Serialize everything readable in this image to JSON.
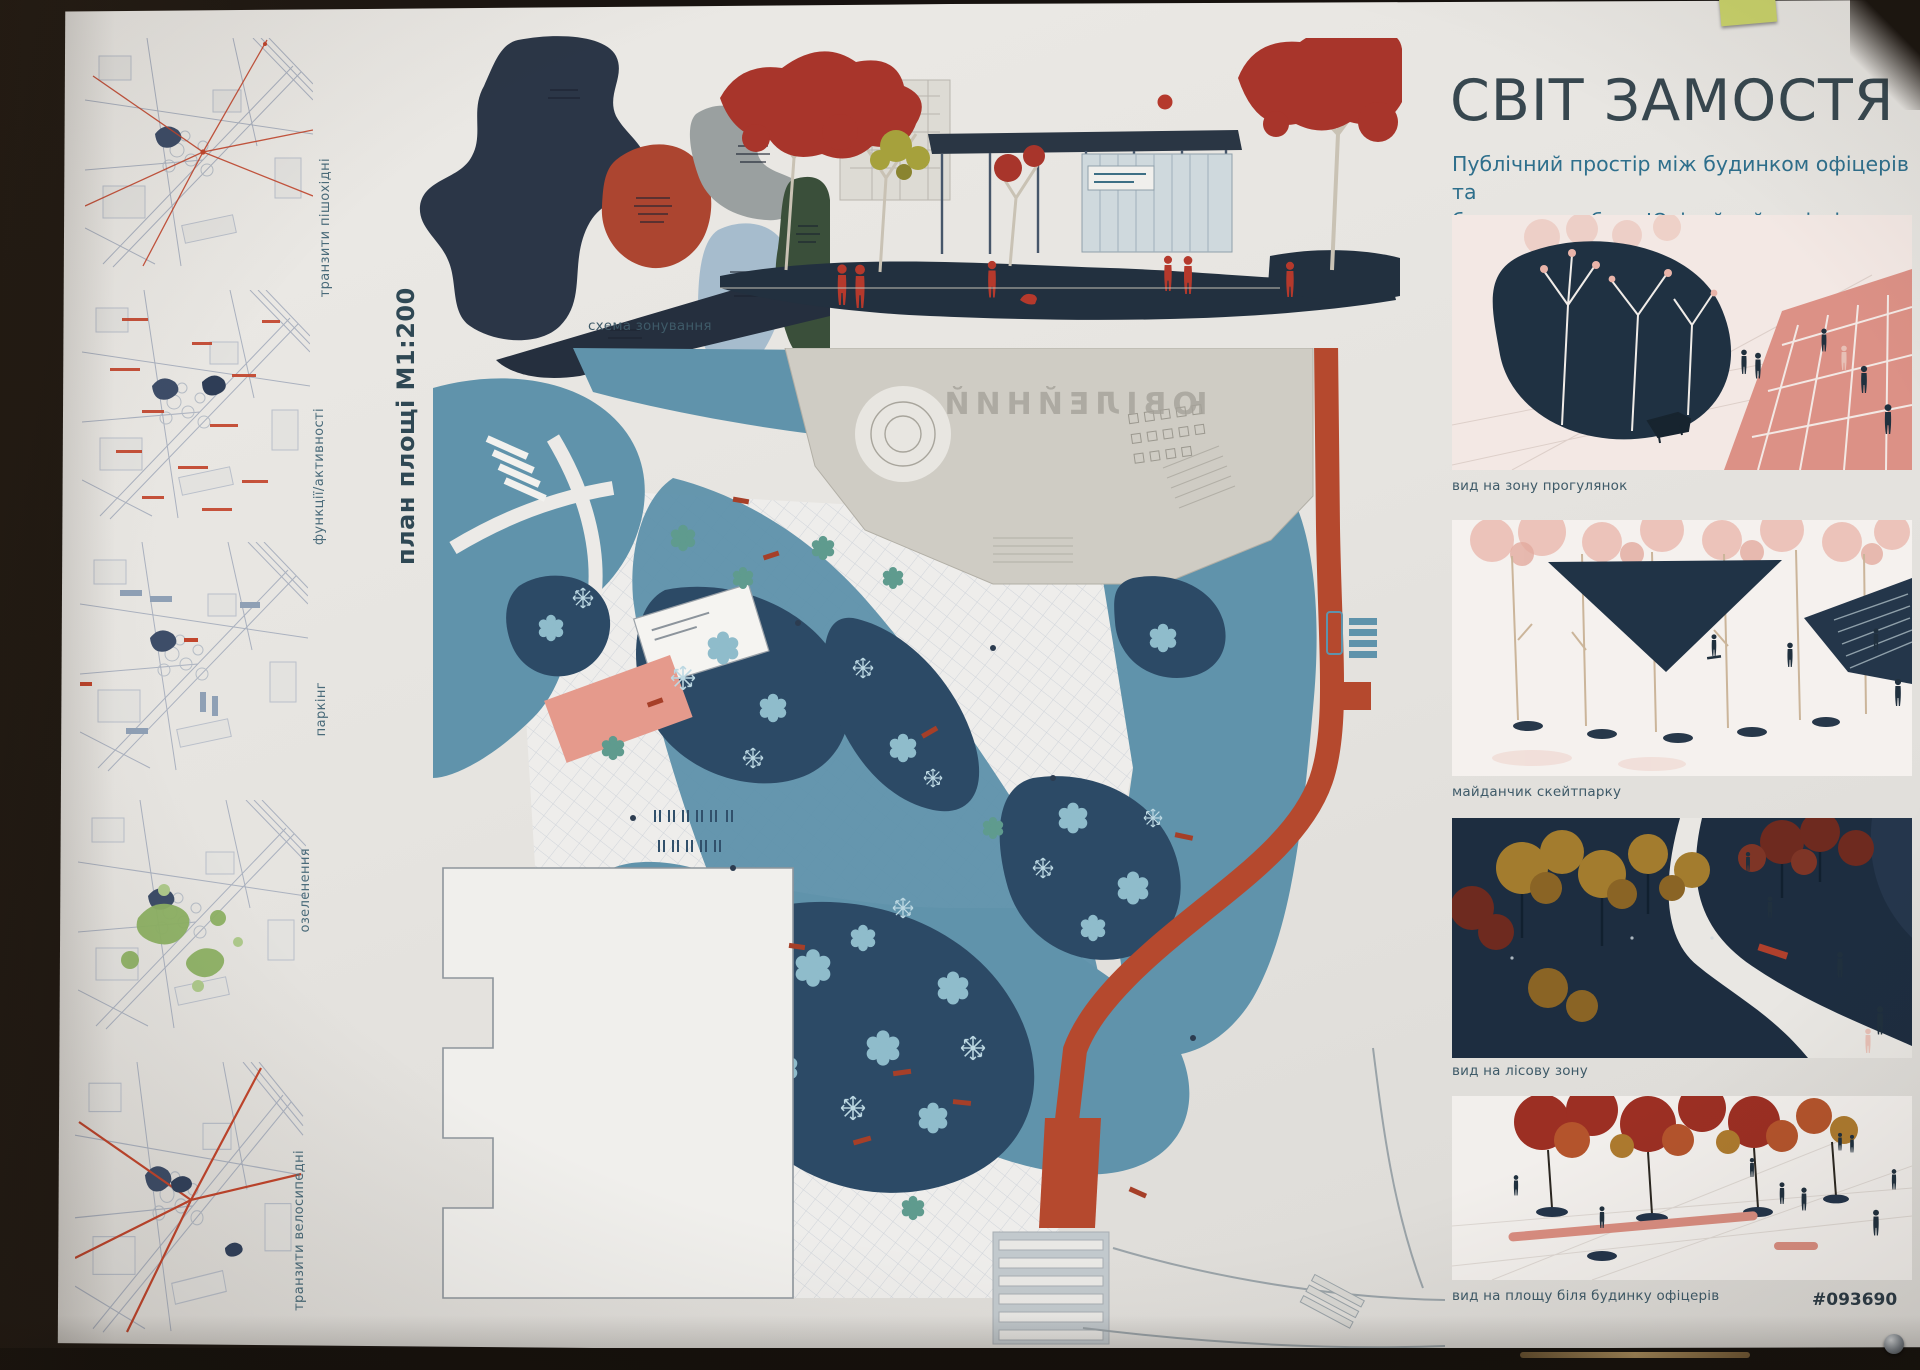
{
  "header": {
    "title": "СВІТ ЗАМОСТЯ",
    "subtitle_line1": "Публічний простір між будинком офіцерів та",
    "subtitle_line2": "будинком побуту Ювілейний у місті Вінниця"
  },
  "board": {
    "code": "#093690"
  },
  "left_maps": {
    "items": [
      {
        "label": "транзити пішохідні"
      },
      {
        "label": "функції/активності"
      },
      {
        "label": "паркінг"
      },
      {
        "label": "озеленення"
      },
      {
        "label": "транзити велосипедні"
      }
    ]
  },
  "zoning": {
    "caption": "схема зонування"
  },
  "plan": {
    "label": "план площі М1:200",
    "building_name": "ЮВІЛЕЙНИЙ"
  },
  "renders": {
    "items": [
      {
        "caption": "вид на зону прогулянок"
      },
      {
        "caption": "майданчик скейтпарку"
      },
      {
        "caption": "вид на лісову зону"
      },
      {
        "caption": "вид на площу біля будинку офіцерів"
      }
    ]
  },
  "colors": {
    "title": "#37474f",
    "subtitle": "#2e6f8c",
    "navy": "#22334a",
    "rust_red": "#b5492e",
    "teal_plaza": "#6093ab",
    "forest_navy": "#2c4a66",
    "light_tree": "#a9cfdd",
    "salmon": "#e59a8c",
    "board_bg": "#e8e6e2"
  }
}
